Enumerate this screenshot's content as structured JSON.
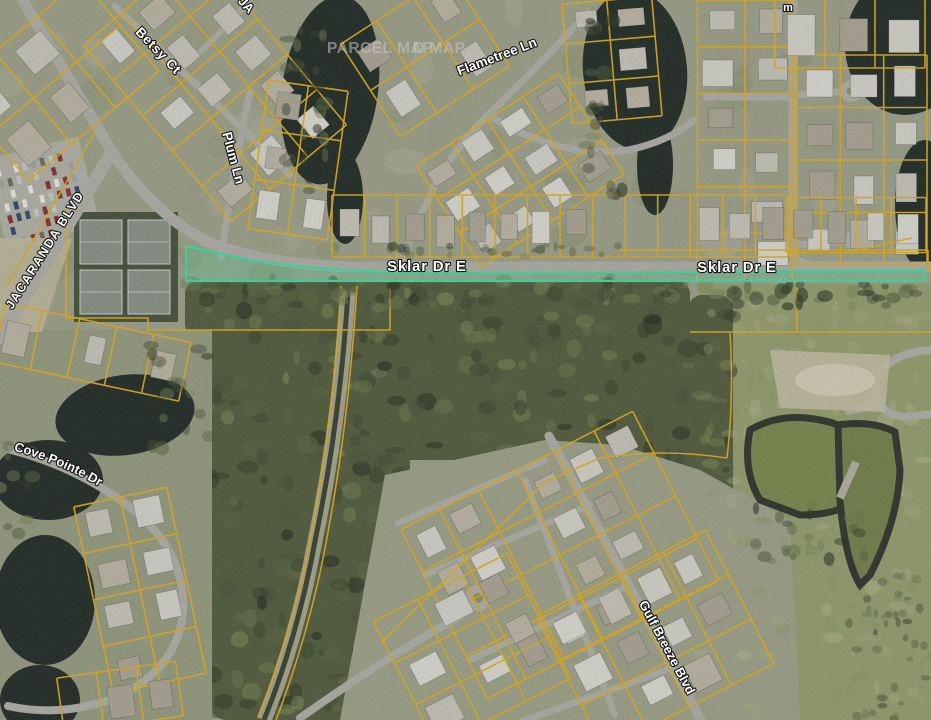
{
  "map": {
    "watermark": {
      "primary": "PARCEL MAP",
      "secondary_partial": "D MAP"
    },
    "labels": {
      "betsy": "Betsy Ct",
      "plum": "Plum Ln",
      "flametree": "Flametree Ln",
      "jacaranda": "JACARANDA BLVD",
      "sklar_west": "Sklar Dr E",
      "sklar_east": "Sklar Dr E",
      "cove_pointe": "Cove Pointe Dr",
      "gulf_breeze": "Gulf Breeze Blvd",
      "partial_top": "JA",
      "partial_top_right": "m"
    },
    "colors": {
      "parcel_line": "#eab41d",
      "highlight_stroke": "#3ee6a5",
      "highlight_fill": "rgba(86,230,170,0.27)",
      "road": "#b4b5ab",
      "water": "#1f2a23",
      "pond_water": "#7d8c4e",
      "label_text": "#ffffff",
      "watermark_text": "#c8c8c4"
    }
  }
}
